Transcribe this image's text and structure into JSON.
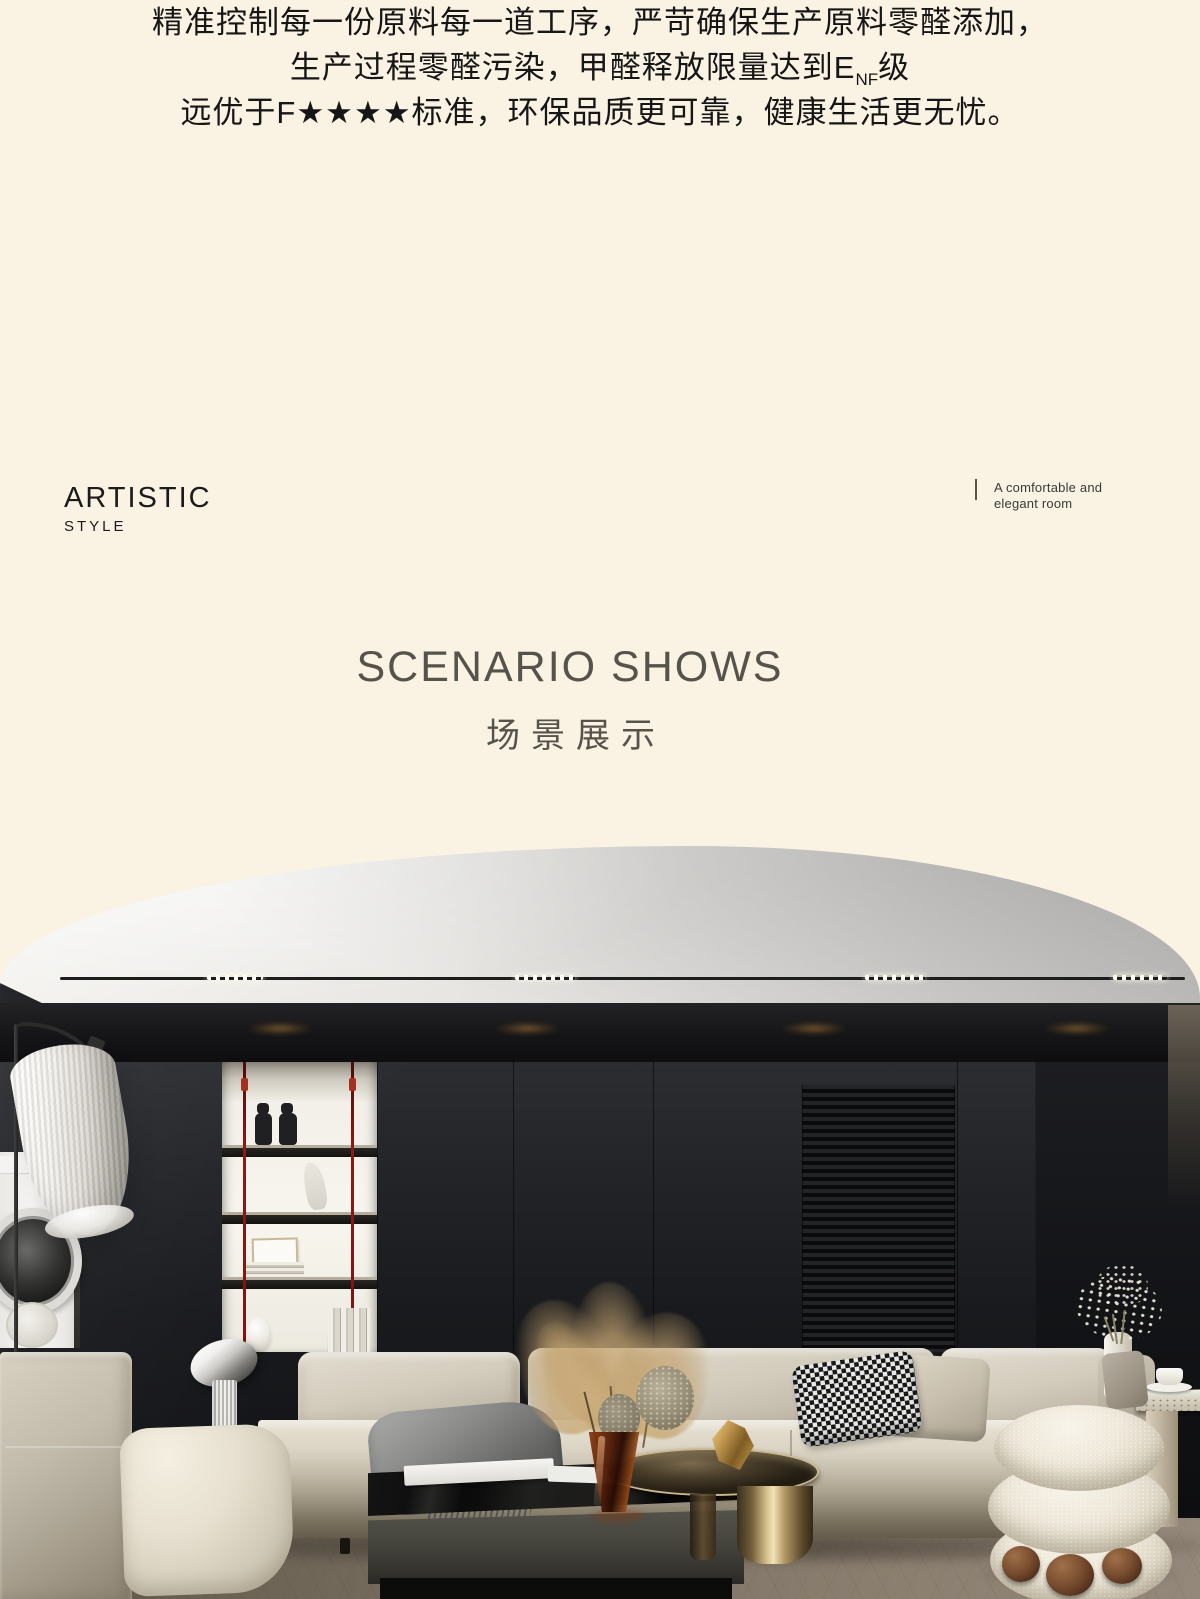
{
  "page": {
    "background_color": "#FAF2E3",
    "width_px": 1200,
    "height_px": 1599
  },
  "intro_paragraph": {
    "line1": "精准控制每一份原料每一道工序，严苛确保生产原料零醛添加，",
    "line2_prefix": "生产过程零醛污染，甲醛释放限量达到E",
    "line2_subscript": "NF",
    "line2_suffix": "级",
    "line3": "远优于F★★★★标准，环保品质更可靠，健康生活更无忧。",
    "text_color": "#161616"
  },
  "style_label": {
    "title": "ARTISTIC",
    "subtitle": "STYLE"
  },
  "room_caption": {
    "line1": "A comfortable and",
    "line2": "elegant room"
  },
  "section_heading": {
    "title_en": "SCENARIO SHOWS",
    "title_cn": "场景展示",
    "color": "#56534B"
  },
  "scene_photo": {
    "type": "interior-render",
    "subject": "modern living room: gray domed ceiling with linear track light, black panel wall with backlit display niche and red cables, louvered panel, beige sectional sofa with houndstooth pillow, black coffee table, bronze round table, boucle pouf, floor lamp, washing machine",
    "colors": {
      "ceiling_gray": "#D8D7D4",
      "wall_black": "#1B1C1F",
      "niche_backlight": "#F5F3EB",
      "cable_red": "#8C1A16",
      "sofa_beige": "#D5CEC0",
      "pouf_cream": "#EFE9DA",
      "bronze": "#C9B184",
      "floor_taupe": "#7D7264",
      "downlight_warm": "#C08A3E"
    }
  }
}
